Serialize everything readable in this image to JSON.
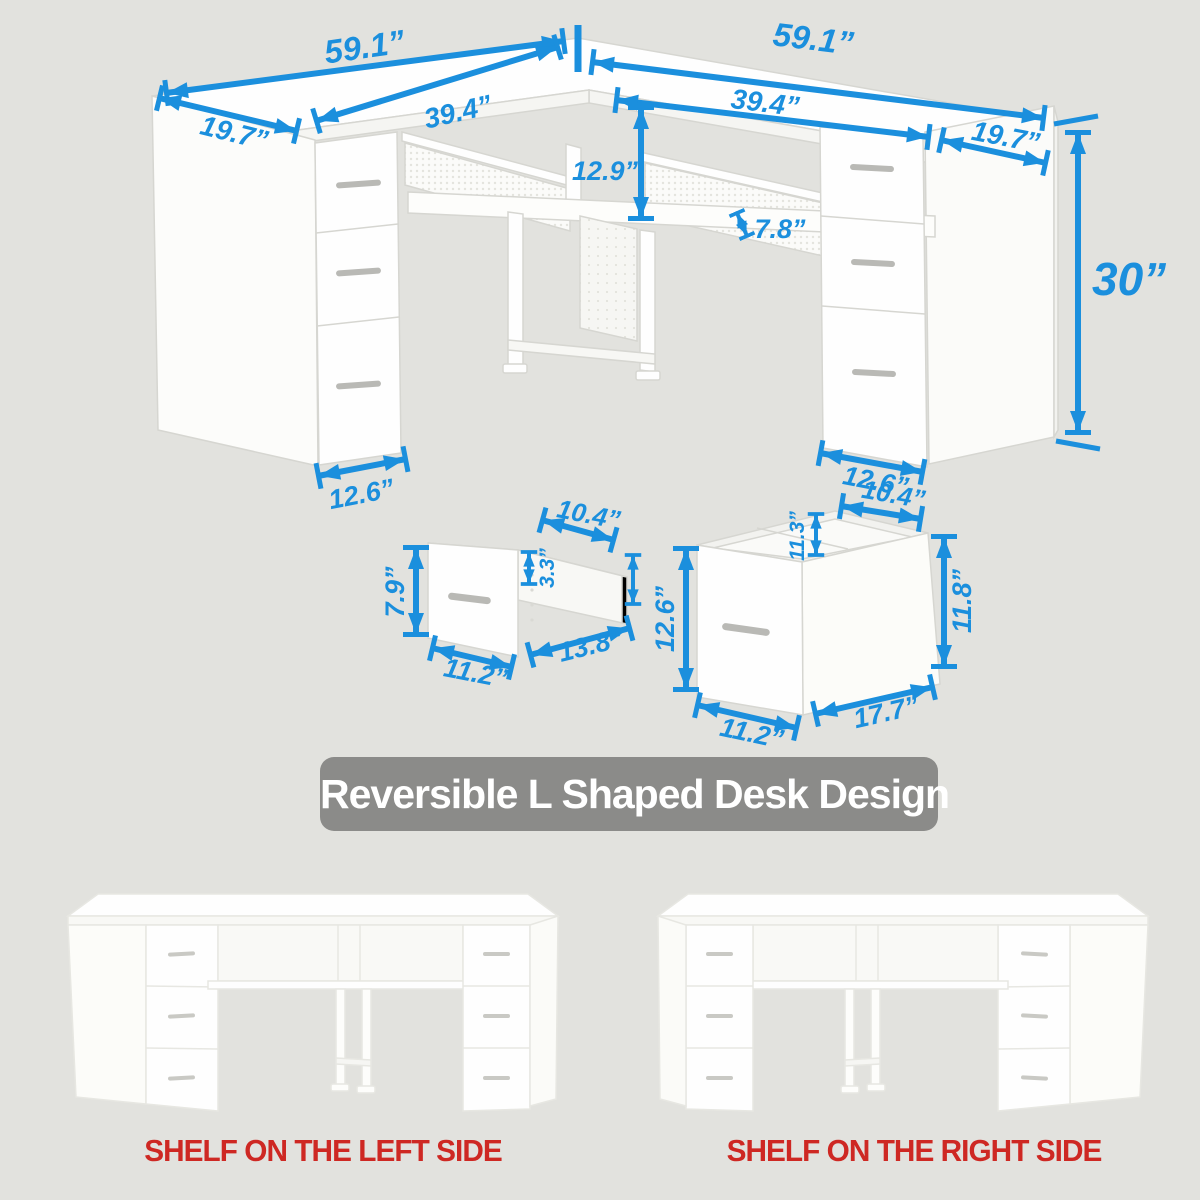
{
  "colors": {
    "background": "#e2e2de",
    "dimension_blue": "#1b8fdd",
    "banner_bg": "#8b8b89",
    "banner_text": "#ffffff",
    "caption_red": "#ce2823"
  },
  "diagram": {
    "top_left_width": "59.1”",
    "top_right_width": "59.1”",
    "left_end_depth": "19.7”",
    "right_end_depth": "19.7”",
    "left_opening_width": "39.4”",
    "right_opening_width": "39.4”",
    "riser_height": "12.9”",
    "shelf_thickness": "7.8”",
    "desk_height": "30”",
    "left_pedestal_width": "12.6”",
    "right_pedestal_width": "12.6”"
  },
  "small_drawer": {
    "top_width": "10.4”",
    "front_height": "7.9”",
    "inner_height": "3.3”",
    "front_width": "11.2”",
    "depth": "13.8”"
  },
  "file_drawer": {
    "top_width": "10.4”",
    "inner_height": "11.3”",
    "left_height": "12.6”",
    "right_height": "11.8”",
    "front_width": "11.2”",
    "depth": "17.7”"
  },
  "banner": {
    "title": "Reversible L Shaped Desk Design"
  },
  "captions": {
    "left": "SHELF ON THE LEFT SIDE",
    "right": "SHELF ON THE RIGHT SIDE"
  }
}
